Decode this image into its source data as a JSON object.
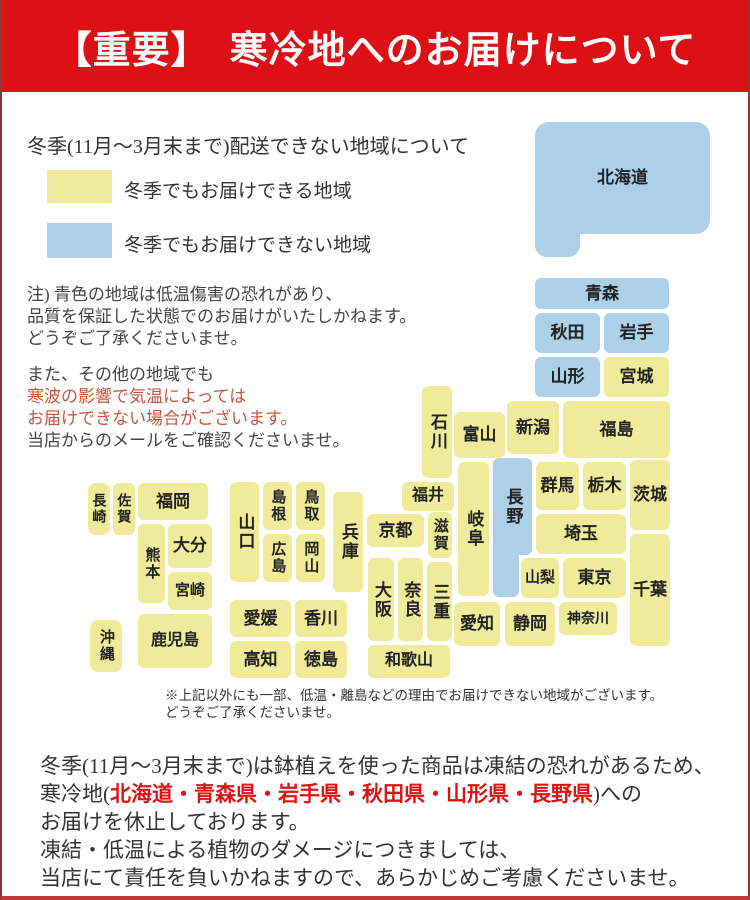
{
  "header": {
    "title": "【重要】　寒冷地へのお届けについて",
    "bg_color": "#dd1016",
    "text_color": "#ffffff"
  },
  "legend": {
    "title": "冬季(11月～3月末まで)配送できない地域について",
    "items": [
      {
        "key": "deliverable",
        "color": "#f0eb9a",
        "label": "冬季でもお届けできる地域"
      },
      {
        "key": "not_deliverable",
        "color": "#abd0e8",
        "label": "冬季でもお届けできない地域"
      }
    ]
  },
  "notes": {
    "note1_lines": [
      "注) 青色の地域は低温傷害の恐れがあり、",
      "品質を保証した状態でのお届けがいたしかねます。",
      "どうぞご了承くださいませ。"
    ],
    "note2_line1": "また、その他の地域でも",
    "note2_red_lines": [
      "寒波の影響で気温によっては",
      "お届けできない場合がございます。"
    ],
    "note2_line4": "当店からのメールをご確認くださいませ。",
    "red_color": "#c7543d"
  },
  "map": {
    "colors": {
      "ok": "#f0eb9a",
      "no": "#abd0e8"
    },
    "prefectures": [
      {
        "id": "hokkaido",
        "label": "北海道",
        "x": 533,
        "y": 122,
        "w": 175,
        "h": 112,
        "c": "no",
        "o": "h",
        "r": 14
      },
      {
        "id": "hokkaido-tab",
        "label": "",
        "x": 533,
        "y": 200,
        "w": 45,
        "h": 57,
        "c": "no",
        "o": "h",
        "r": 12
      },
      {
        "id": "aomori",
        "label": "青森",
        "x": 533,
        "y": 278,
        "w": 134,
        "h": 31,
        "c": "no",
        "o": "h"
      },
      {
        "id": "akita",
        "label": "秋田",
        "x": 533,
        "y": 313,
        "w": 65,
        "h": 40,
        "c": "no",
        "o": "h"
      },
      {
        "id": "iwate",
        "label": "岩手",
        "x": 602,
        "y": 313,
        "w": 65,
        "h": 40,
        "c": "no",
        "o": "h"
      },
      {
        "id": "yamagata",
        "label": "山形",
        "x": 533,
        "y": 357,
        "w": 65,
        "h": 40,
        "c": "no",
        "o": "h"
      },
      {
        "id": "miyagi",
        "label": "宮城",
        "x": 602,
        "y": 357,
        "w": 65,
        "h": 40,
        "c": "ok",
        "o": "h"
      },
      {
        "id": "niigata",
        "label": "新潟",
        "x": 505,
        "y": 401,
        "w": 52,
        "h": 53,
        "c": "ok",
        "o": "h"
      },
      {
        "id": "fukushima",
        "label": "福島",
        "x": 561,
        "y": 401,
        "w": 107,
        "h": 57,
        "c": "ok",
        "o": "h"
      },
      {
        "id": "ishikawa",
        "label": "石川",
        "x": 420,
        "y": 386,
        "w": 30,
        "h": 92,
        "c": "ok",
        "o": "v"
      },
      {
        "id": "toyama",
        "label": "富山",
        "x": 452,
        "y": 412,
        "w": 51,
        "h": 46,
        "c": "ok",
        "o": "h"
      },
      {
        "id": "fukui",
        "label": "福井",
        "x": 400,
        "y": 482,
        "w": 52,
        "h": 29,
        "c": "ok",
        "o": "h",
        "fs": 16
      },
      {
        "id": "gifu",
        "label": "岐阜",
        "x": 456,
        "y": 462,
        "w": 31,
        "h": 134,
        "c": "ok",
        "o": "v"
      },
      {
        "id": "nagano",
        "label": "長野",
        "x": 491,
        "y": 458,
        "w": 39,
        "h": 97,
        "c": "no",
        "o": "v"
      },
      {
        "id": "nagano-tab",
        "label": "",
        "x": 491,
        "y": 530,
        "w": 26,
        "h": 67,
        "c": "no",
        "o": "h"
      },
      {
        "id": "gunma",
        "label": "群馬",
        "x": 534,
        "y": 462,
        "w": 43,
        "h": 48,
        "c": "ok",
        "o": "h"
      },
      {
        "id": "tochigi",
        "label": "栃木",
        "x": 581,
        "y": 462,
        "w": 43,
        "h": 48,
        "c": "ok",
        "o": "h"
      },
      {
        "id": "ibaraki",
        "label": "茨城",
        "x": 628,
        "y": 460,
        "w": 40,
        "h": 70,
        "c": "ok",
        "o": "h"
      },
      {
        "id": "saitama",
        "label": "埼玉",
        "x": 534,
        "y": 514,
        "w": 90,
        "h": 40,
        "c": "ok",
        "o": "h"
      },
      {
        "id": "yamanashi",
        "label": "山梨",
        "x": 519,
        "y": 558,
        "w": 38,
        "h": 40,
        "c": "ok",
        "o": "h",
        "fs": 15
      },
      {
        "id": "tokyo",
        "label": "東京",
        "x": 561,
        "y": 558,
        "w": 63,
        "h": 40,
        "c": "ok",
        "o": "h"
      },
      {
        "id": "chiba",
        "label": "千葉",
        "x": 628,
        "y": 534,
        "w": 40,
        "h": 112,
        "c": "ok",
        "o": "h"
      },
      {
        "id": "kanagawa",
        "label": "神奈川",
        "x": 557,
        "y": 602,
        "w": 58,
        "h": 33,
        "c": "ok",
        "o": "h",
        "fs": 14
      },
      {
        "id": "shizuoka",
        "label": "静岡",
        "x": 503,
        "y": 602,
        "w": 50,
        "h": 44,
        "c": "ok",
        "o": "h"
      },
      {
        "id": "aichi",
        "label": "愛知",
        "x": 452,
        "y": 602,
        "w": 46,
        "h": 44,
        "c": "ok",
        "o": "h"
      },
      {
        "id": "kyoto",
        "label": "京都",
        "x": 365,
        "y": 514,
        "w": 57,
        "h": 33,
        "c": "ok",
        "o": "h"
      },
      {
        "id": "shiga",
        "label": "滋賀",
        "x": 426,
        "y": 512,
        "w": 24,
        "h": 46,
        "c": "ok",
        "o": "v",
        "fs": 15
      },
      {
        "id": "hyogo",
        "label": "兵庫",
        "x": 331,
        "y": 492,
        "w": 30,
        "h": 100,
        "c": "ok",
        "o": "v"
      },
      {
        "id": "osaka",
        "label": "大阪",
        "x": 366,
        "y": 558,
        "w": 26,
        "h": 83,
        "c": "ok",
        "o": "v"
      },
      {
        "id": "nara",
        "label": "奈良",
        "x": 396,
        "y": 558,
        "w": 25,
        "h": 83,
        "c": "ok",
        "o": "v"
      },
      {
        "id": "mie",
        "label": "三重",
        "x": 425,
        "y": 562,
        "w": 25,
        "h": 79,
        "c": "ok",
        "o": "v"
      },
      {
        "id": "wakayama",
        "label": "和歌山",
        "x": 366,
        "y": 645,
        "w": 82,
        "h": 33,
        "c": "ok",
        "o": "h",
        "fs": 16
      },
      {
        "id": "yamaguchi",
        "label": "山口",
        "x": 228,
        "y": 482,
        "w": 29,
        "h": 100,
        "c": "ok",
        "o": "v"
      },
      {
        "id": "shimane",
        "label": "島根",
        "x": 261,
        "y": 482,
        "w": 29,
        "h": 48,
        "c": "ok",
        "o": "v",
        "fs": 15
      },
      {
        "id": "tottori",
        "label": "鳥取",
        "x": 294,
        "y": 482,
        "w": 29,
        "h": 48,
        "c": "ok",
        "o": "v",
        "fs": 15
      },
      {
        "id": "hiroshima",
        "label": "広島",
        "x": 261,
        "y": 534,
        "w": 29,
        "h": 48,
        "c": "ok",
        "o": "v",
        "fs": 15
      },
      {
        "id": "okayama",
        "label": "岡山",
        "x": 294,
        "y": 534,
        "w": 29,
        "h": 48,
        "c": "ok",
        "o": "v",
        "fs": 15
      },
      {
        "id": "ehime",
        "label": "愛媛",
        "x": 228,
        "y": 600,
        "w": 61,
        "h": 37,
        "c": "ok",
        "o": "h"
      },
      {
        "id": "kagawa",
        "label": "香川",
        "x": 293,
        "y": 600,
        "w": 52,
        "h": 37,
        "c": "ok",
        "o": "h"
      },
      {
        "id": "kochi",
        "label": "高知",
        "x": 228,
        "y": 641,
        "w": 61,
        "h": 37,
        "c": "ok",
        "o": "h"
      },
      {
        "id": "tokushima",
        "label": "徳島",
        "x": 293,
        "y": 641,
        "w": 52,
        "h": 37,
        "c": "ok",
        "o": "h"
      },
      {
        "id": "nagasaki",
        "label": "長崎",
        "x": 86,
        "y": 483,
        "w": 22,
        "h": 52,
        "c": "ok",
        "o": "v",
        "fs": 14,
        "r": 8
      },
      {
        "id": "saga",
        "label": "佐賀",
        "x": 111,
        "y": 483,
        "w": 22,
        "h": 52,
        "c": "ok",
        "o": "v",
        "fs": 14
      },
      {
        "id": "fukuoka",
        "label": "福岡",
        "x": 136,
        "y": 483,
        "w": 70,
        "h": 37,
        "c": "ok",
        "o": "h"
      },
      {
        "id": "kumamoto",
        "label": "熊本",
        "x": 136,
        "y": 524,
        "w": 27,
        "h": 79,
        "c": "ok",
        "o": "v",
        "fs": 15
      },
      {
        "id": "oita",
        "label": "大分",
        "x": 166,
        "y": 524,
        "w": 44,
        "h": 44,
        "c": "ok",
        "o": "h"
      },
      {
        "id": "miyazaki",
        "label": "宮崎",
        "x": 166,
        "y": 572,
        "w": 44,
        "h": 38,
        "c": "ok",
        "o": "h",
        "fs": 15
      },
      {
        "id": "kagoshima",
        "label": "鹿児島",
        "x": 136,
        "y": 614,
        "w": 74,
        "h": 54,
        "c": "ok",
        "o": "h",
        "fs": 16
      },
      {
        "id": "okinawa",
        "label": "沖縄",
        "x": 88,
        "y": 620,
        "w": 32,
        "h": 52,
        "c": "ok",
        "o": "v",
        "fs": 15,
        "r": 8
      }
    ]
  },
  "footnote": {
    "line1": "※上記以外にも一部、低温・離島などの理由でお届けできない地域がございます。",
    "line2": "どうぞご了承くださいませ。"
  },
  "footer": {
    "line1": "冬季(11月～3月末まで)は鉢植えを使った商品は凍結の恐れがあるため、",
    "line2_prefix": "寒冷地(",
    "line2_red": "北海道・青森県・岩手県・秋田県・山形県・長野県",
    "line2_suffix": ")への",
    "line3": "お届けを休止しております。",
    "line4": "凍結・低温による植物のダメージにつきましては、",
    "line5": "当店にて責任を負いかねますので、あらかじめご考慮くださいませ。",
    "red_color": "#dc1414"
  }
}
